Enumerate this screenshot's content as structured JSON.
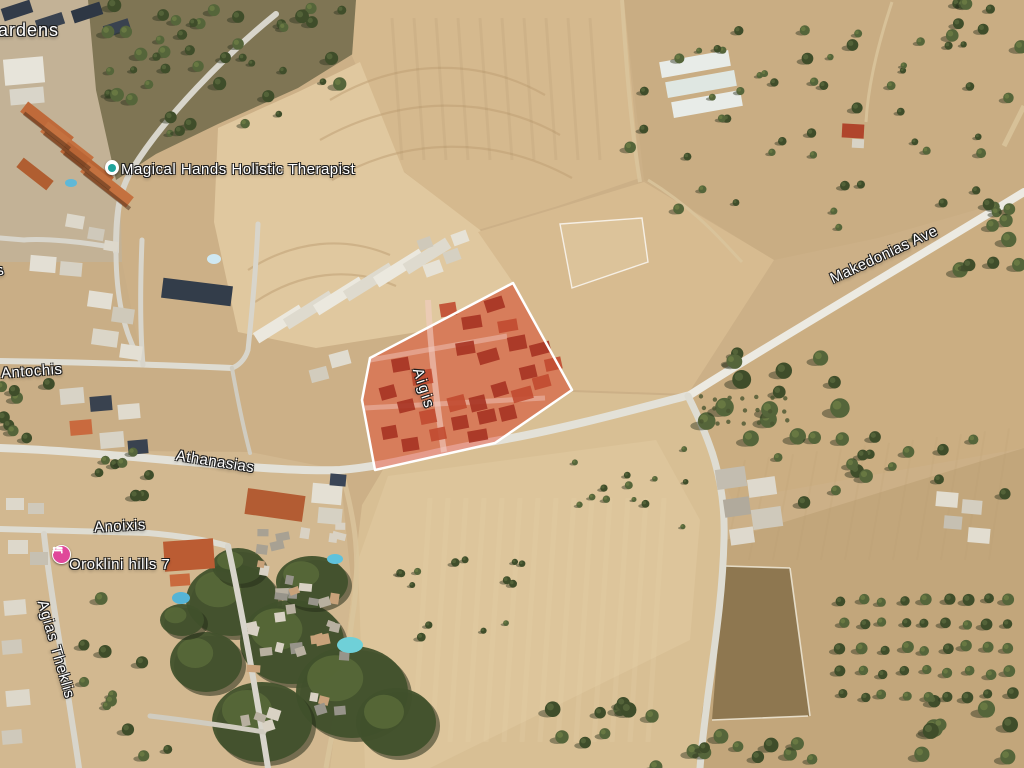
{
  "map": {
    "view": "satellite",
    "labels": [
      {
        "id": "gardens-fragment",
        "text": "ardens"
      },
      {
        "id": "magical-hands",
        "text": "Magical Hands Holistic Therapist"
      },
      {
        "id": "antochis",
        "text": "Antochis"
      },
      {
        "id": "athanasias",
        "text": "Athanasias"
      },
      {
        "id": "aigis",
        "text": "Aigis"
      },
      {
        "id": "makedonias-ave",
        "text": "Makedonias Ave"
      },
      {
        "id": "anoixis",
        "text": "Anoixis"
      },
      {
        "id": "oroklini-hills",
        "text": "Oroklini hills 7"
      },
      {
        "id": "agias-theklis",
        "text": "Agias Theklis"
      },
      {
        "id": "left-edge-fragment",
        "text": "s"
      }
    ],
    "pois": [
      {
        "id": "magical-hands-marker",
        "label": "Magical Hands Holistic Therapist",
        "icon": "spa",
        "icon_color": "#1fa39b",
        "bg": "#ffffff"
      },
      {
        "id": "oroklini-marker",
        "label": "Oroklini hills 7",
        "icon": "lodging",
        "icon_color": "#ffffff",
        "bg": "#e0489a"
      }
    ],
    "highlight": {
      "fill": "#e8311a",
      "fill_opacity": 0.4,
      "stroke": "#ffffff",
      "stroke_width": 2.5,
      "points": "513,283 572,390 495,443 375,470 362,400 370,358"
    }
  }
}
